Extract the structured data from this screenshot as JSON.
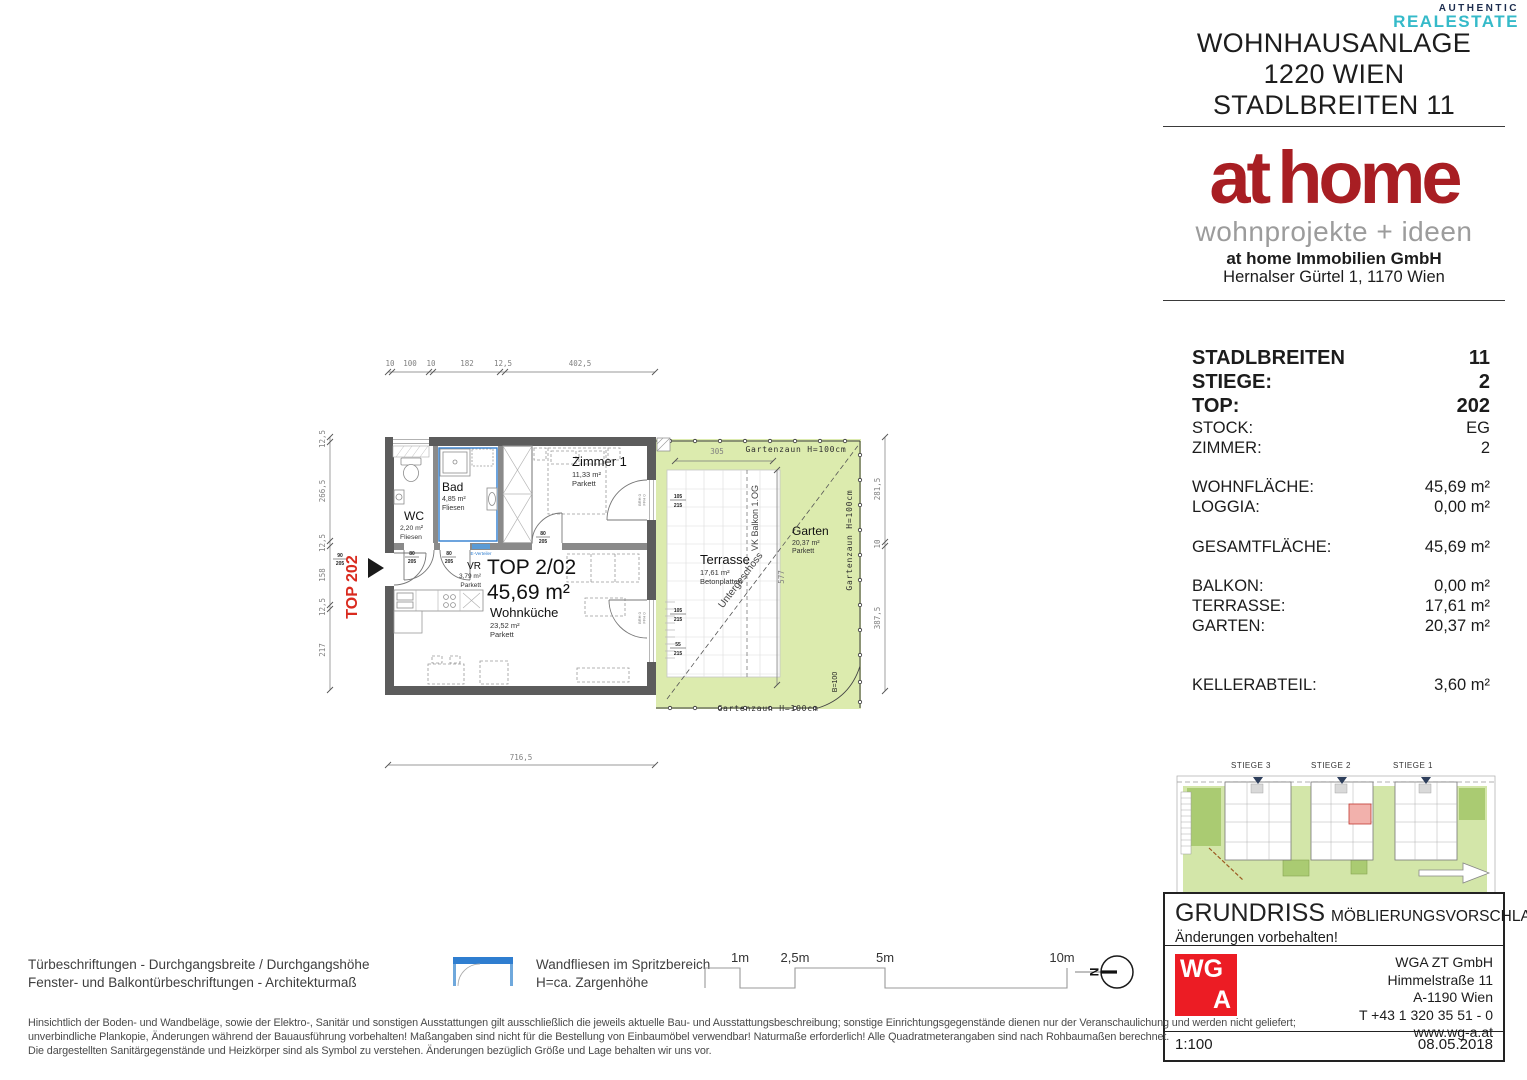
{
  "watermark": {
    "line1": "AUTHENTIC",
    "line2": "REALESTATE"
  },
  "header": {
    "line1": "WOHNHAUSANLAGE",
    "line2": "1220 WIEN",
    "line3": "STADLBREITEN 11"
  },
  "brand": {
    "logo_at": "at",
    "logo_home": "home",
    "tagline": "wohnprojekte + ideen",
    "company": "at home Immobilien GmbH",
    "address": "Hernalser Gürtel 1, 1170 Wien"
  },
  "info": {
    "rows": [
      {
        "label": "STADLBREITEN",
        "value": "11"
      },
      {
        "label": "STIEGE:",
        "value": "2"
      },
      {
        "label": "TOP:",
        "value": "202"
      },
      {
        "label": "STOCK:",
        "value": "EG"
      },
      {
        "label": "ZIMMER:",
        "value": "2"
      },
      {
        "label": "WOHNFLÄCHE:",
        "value": "45,69 m²"
      },
      {
        "label": "LOGGIA:",
        "value": "0,00 m²"
      },
      {
        "label": "GESAMTFLÄCHE:",
        "value": "45,69 m²"
      },
      {
        "label": "BALKON:",
        "value": "0,00 m²"
      },
      {
        "label": "TERRASSE:",
        "value": "17,61 m²"
      },
      {
        "label": "GARTEN:",
        "value": "20,37 m²"
      },
      {
        "label": "KELLERABTEIL:",
        "value": "3,60 m²"
      }
    ]
  },
  "plan": {
    "entry_label": "TOP 202",
    "unit": {
      "name": "TOP 2/02",
      "area": "45,69 m²"
    },
    "rooms": {
      "wc": {
        "name": "WC",
        "area": "2,20 m²",
        "floor": "Fliesen"
      },
      "bad": {
        "name": "Bad",
        "area": "4,85 m²",
        "floor": "Fliesen"
      },
      "zimmer1": {
        "name": "Zimmer 1",
        "area": "11,33 m²",
        "floor": "Parkett"
      },
      "vr": {
        "name": "VR",
        "area": "3,79 m²",
        "floor": "Parkett"
      },
      "wohnkueche": {
        "name": "Wohnküche",
        "area": "23,52 m²",
        "floor": "Parkett"
      },
      "terrasse": {
        "name": "Terrasse",
        "area": "17,61 m²",
        "floor": "Betonplatten"
      },
      "garten": {
        "name": "Garten",
        "area": "20,37 m²",
        "floor": "Parkett"
      }
    },
    "annotations": {
      "fence_top": "Gartenzaun H=100cm",
      "fence_right": "Gartenzaun H=100cm",
      "fence_bottom": "Gartenzaun H=100cm",
      "vk_balkon": "VK Balkon 1.OG",
      "untergeschoss": "Untergeschoss",
      "gate": "B=100",
      "e_verteiler": "E-Verteiler"
    },
    "dims": {
      "top1": "10",
      "top2": "100",
      "top3": "10",
      "top4": "182",
      "top5": "12,5",
      "top6": "402,5",
      "left1": "12,5",
      "left2": "266,5",
      "left3": "12,5",
      "left4": "158",
      "left5": "12,5",
      "left6": "217",
      "bottom": "716,5",
      "garden_w": "305",
      "garden_h": "577",
      "right1": "281,5",
      "right2": "10",
      "right3": "387,5"
    },
    "openings": {
      "entry_w": "90",
      "entry_h": "205",
      "door_w": "80",
      "door_h": "205",
      "win_w": "105",
      "win_h": "215",
      "win2_w": "55",
      "win2_h": "215",
      "brh": "BRH 0",
      "ffh": "FFH 0"
    }
  },
  "siteplan": {
    "stiege3": "STIEGE 3",
    "stiege2": "STIEGE 2",
    "stiege1": "STIEGE 1"
  },
  "titleblock": {
    "title": "GRUNDRISS",
    "subtitle": "MÖBLIERUNGSVORSCHLAG",
    "note": "Änderungen vorbehalten!",
    "logo_top": "WG",
    "logo_bottom": "A",
    "firm": "WGA ZT GmbH",
    "street": "Himmelstraße 11",
    "city": "A-1190 Wien",
    "phone": "T +43 1 320 35 51 - 0",
    "web": "www.wg-a.at",
    "scale": "1:100",
    "date": "08.05.2018"
  },
  "legend": {
    "door_line1": "Türbeschriftungen - Durchgangsbreite / Durchgangshöhe",
    "door_line2": "Fenster- und Balkontürbeschriftungen - Architekturmaß",
    "tile_line1": "Wandfliesen im Spritzbereich",
    "tile_line2": "H=ca. Zargenhöhe"
  },
  "scalebar": {
    "m1": "1m",
    "m2": "2,5m",
    "m3": "5m",
    "m4": "10m",
    "north": "N"
  },
  "disclaimer": {
    "line1": "Hinsichtlich der Boden- und Wandbeläge, sowie der Elektro-, Sanitär und sonstigen Ausstattungen gilt ausschließlich die jeweils aktuelle Bau- und Ausstattungsbeschreibung; sonstige Einrichtungsgegenstände dienen nur der Veranschaulichung und werden nicht geliefert;",
    "line2": "unverbindliche Plankopie, Änderungen während der Bauausführung vorbehalten! Maßangaben sind nicht für die Bestellung von Einbaumöbel verwendbar! Naturmaße erforderlich! Alle Quadratmeterangaben sind nach Rohbaumaßen berechnet.",
    "line3": "Die dargestellten Sanitärgegenstände und Heizkörper sind als Symbol zu verstehen. Änderungen bezüglich Größe und Lage behalten wir uns vor."
  },
  "colors": {
    "brand_red": "#a81e23",
    "wga_red": "#ec1c24",
    "top_red": "#d92b1f",
    "garden_green": "#dcebae",
    "tile_blue": "#2f7ed0",
    "watermark_teal": "#35bac9",
    "siteplan_highlight": "#f2b1ac"
  }
}
